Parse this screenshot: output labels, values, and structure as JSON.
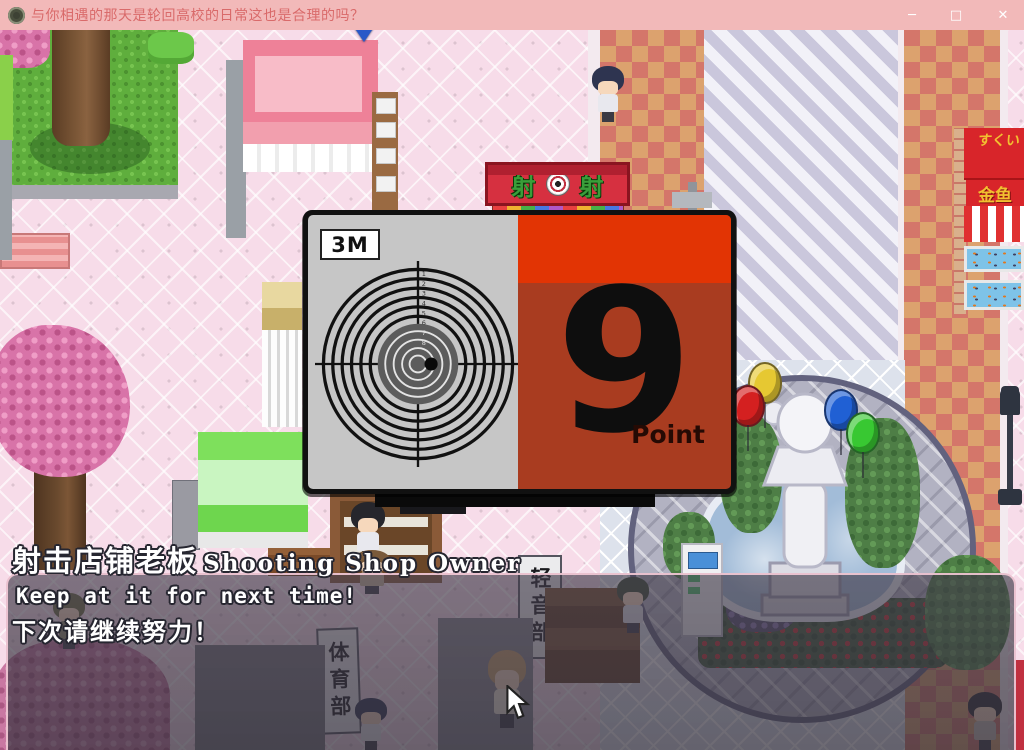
{
  "titlebar": {
    "title": "与你相遇的那天是轮回高校的日常这也是合理的吗？",
    "minimize": "─",
    "maximize": "□",
    "close": "✕"
  },
  "score_panel": {
    "distance": "3M",
    "score": "9",
    "unit": "Point",
    "ring_numbers": [
      "1",
      "2",
      "3",
      "4",
      "5",
      "6",
      "7",
      "8"
    ]
  },
  "signs": {
    "shoot_left": "射",
    "shoot_right": "射",
    "sports_club": "体育部",
    "light_music_club": "轻音部",
    "goldfish": "金鱼",
    "goldfish_awning": "すくい"
  },
  "dialogue": {
    "speaker_cn": "射击店铺老板",
    "speaker_en": "Shooting Shop Owner",
    "line_en": "Keep at it for next time!",
    "line_cn": "下次请继续努力！"
  },
  "colors": {
    "titlebar": "#f2b9b9",
    "panel_red_top": "#e23404",
    "panel_red": "#a93c20",
    "target_gray": "#c6c6c6"
  },
  "characters": [
    {
      "name": "npc-student-navy",
      "x": 591,
      "y": 36,
      "w": 34,
      "h": 56,
      "hair": "#2e3450",
      "shirt": "#e8e8ee"
    },
    {
      "name": "npc-girl-bob",
      "x": 350,
      "y": 472,
      "w": 36,
      "h": 60,
      "hair": "#26262c",
      "shirt": "#e8e8ee"
    },
    {
      "name": "npc-shop-owner",
      "x": 352,
      "y": 520,
      "w": 40,
      "h": 44,
      "hair": "#7a5a3a",
      "shirt": "#c8b49a"
    },
    {
      "name": "npc-boy-green",
      "x": 616,
      "y": 547,
      "w": 34,
      "h": 56,
      "hair": "#3a4a34",
      "shirt": "#dcdce4"
    },
    {
      "name": "npc-girl-blonde",
      "x": 486,
      "y": 620,
      "w": 42,
      "h": 78,
      "hair": "#c8a06a",
      "shirt": "#f0ead8"
    },
    {
      "name": "npc-boy-navy-2",
      "x": 354,
      "y": 668,
      "w": 34,
      "h": 52,
      "hair": "#2e3450",
      "shirt": "#e8e8ee"
    },
    {
      "name": "npc-girl-left",
      "x": 52,
      "y": 563,
      "w": 34,
      "h": 56,
      "hair": "#6a6a42",
      "shirt": "#8a8a6a"
    },
    {
      "name": "npc-girl-right",
      "x": 966,
      "y": 662,
      "w": 38,
      "h": 58,
      "hair": "#2a2a30",
      "shirt": "#c8c0b4"
    }
  ],
  "balloons": [
    {
      "name": "balloon-yellow",
      "x": 748,
      "y": 332,
      "color": "#e6c832"
    },
    {
      "name": "balloon-red",
      "x": 731,
      "y": 355,
      "color": "#d42020"
    },
    {
      "name": "balloon-blue",
      "x": 824,
      "y": 359,
      "color": "#2060d4"
    },
    {
      "name": "balloon-green",
      "x": 846,
      "y": 382,
      "color": "#38c832"
    }
  ]
}
